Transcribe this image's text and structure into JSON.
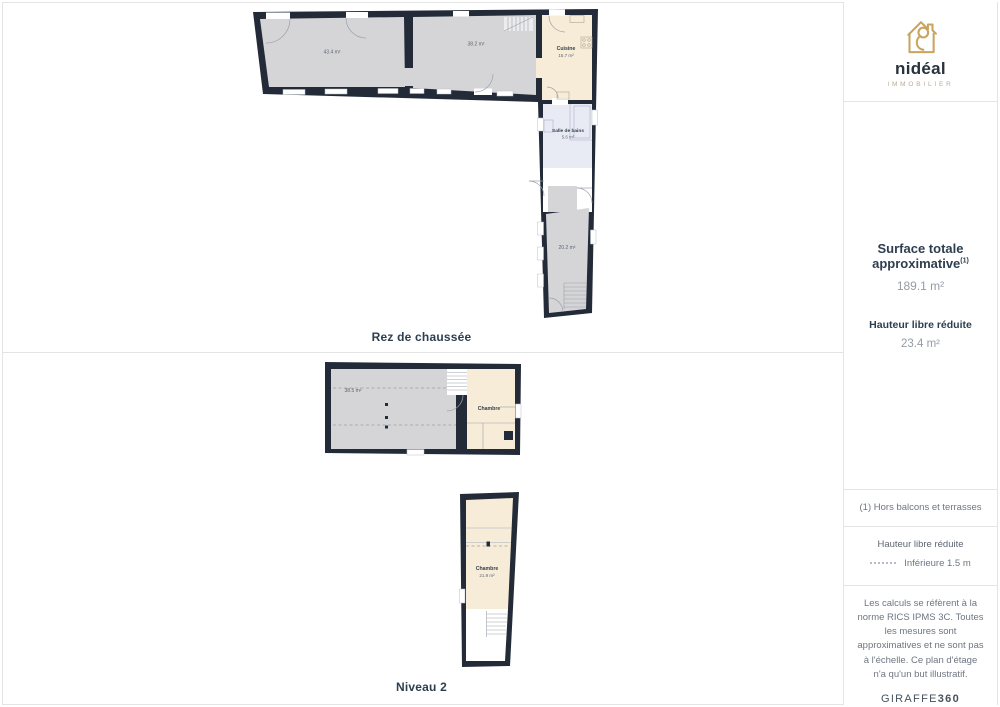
{
  "sidebar": {
    "brand": {
      "wordmark": "nidéal",
      "tagline": "IMMOBILIER"
    },
    "surface": {
      "title": "Surface totale approximative",
      "footnote_marker": "(1)",
      "total": "189.1 m²",
      "reduced_label": "Hauteur libre réduite",
      "reduced_value": "23.4 m²"
    },
    "footnote": "(1) Hors balcons et terrasses",
    "legend": {
      "title": "Hauteur libre réduite",
      "item": "Inférieure 1.5 m"
    },
    "disclaimer": "Les calculs se réfèrent à la norme RICS IPMS 3C. Toutes les mesures sont approximatives et ne sont pas à l'échelle. Ce plan d'étage n'a qu'un but illustratif.",
    "brand360": {
      "giraffe": "GIRAFFE",
      "num": "360"
    }
  },
  "floors": {
    "ground": {
      "label": "Rez de chaussée",
      "rooms": {
        "living_area": "43.4 m²",
        "dining_area": "38.2 m²",
        "kitchen_name": "Cuisine",
        "kitchen_area": "15.7 m²",
        "bathroom_name": "Salle de bains",
        "bathroom_area": "5.6 m²",
        "back_room_area": "20.2 m²"
      }
    },
    "level2": {
      "label": "Niveau 2",
      "rooms": {
        "open_area": "38.5 m²",
        "bedroom1_name": "Chambre",
        "bedroom2_name": "Chambre",
        "bedroom2_area": "21.9 m²"
      }
    }
  },
  "colors": {
    "wall": "#232b38",
    "room_gray": "#d5d5d7",
    "room_beige": "#f7ecd8",
    "room_bath": "#e9ebf4",
    "accent_gold": "#c8a45f",
    "text_navy": "#2d3e50"
  }
}
